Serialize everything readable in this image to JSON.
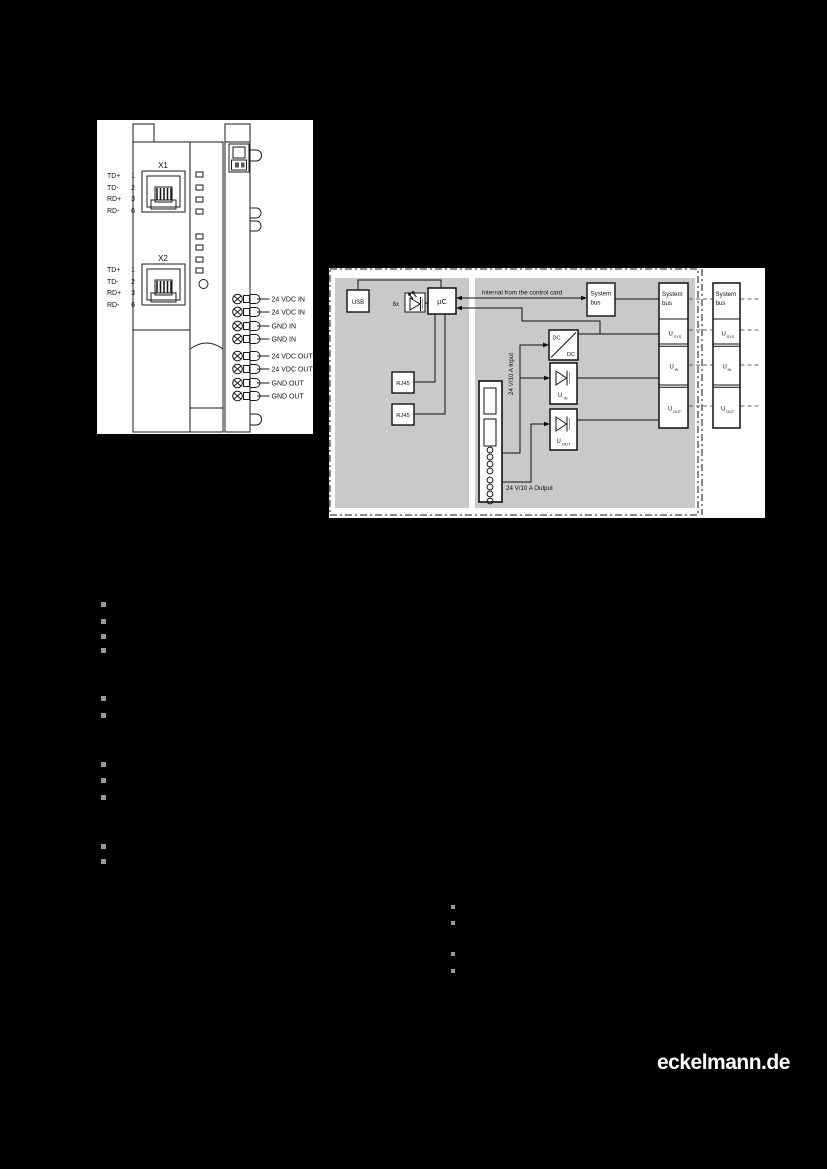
{
  "page": {
    "brand_link": "eckelmann.de"
  },
  "colors": {
    "panel_gray": "#c9c9c9",
    "diagram_bg": "#ffffff",
    "bullet_gray": "#999999"
  },
  "device_diagram": {
    "connector_x1": {
      "label": "X1",
      "pins": [
        {
          "signal": "TD+",
          "pin": "1"
        },
        {
          "signal": "TD-",
          "pin": "2"
        },
        {
          "signal": "RD+",
          "pin": "3"
        },
        {
          "signal": "RD-",
          "pin": "6"
        }
      ]
    },
    "connector_x2": {
      "label": "X2",
      "pins": [
        {
          "signal": "TD+",
          "pin": "1"
        },
        {
          "signal": "TD-",
          "pin": "2"
        },
        {
          "signal": "RD+",
          "pin": "3"
        },
        {
          "signal": "RD-",
          "pin": "6"
        }
      ]
    },
    "terminals": [
      "24 VDC IN",
      "24 VDC IN",
      "GND IN",
      "GND IN",
      "24 VDC OUT",
      "24 VDC OUT",
      "GND OUT",
      "GND OUT"
    ]
  },
  "block_diagram": {
    "usb_label": "USB",
    "led_label": "8x",
    "mcu_label": "µC",
    "rj45_top": "RJ45",
    "rj45_bottom": "RJ45",
    "internal_note": "Internal from the control card",
    "system_bus_mid": {
      "line1": "System",
      "line2": "bus"
    },
    "dc_dc": {
      "top": "DC",
      "bottom": "DC"
    },
    "input_label": "24 V/10 A Input",
    "output_label": "24 V/10 A Output",
    "sense_in": {
      "base": "U",
      "sub": "IN"
    },
    "sense_out": {
      "base": "U",
      "sub": "OUT"
    },
    "inner_stack": {
      "bus_line1": "System",
      "bus_line2": "bus",
      "u_sys": {
        "base": "U",
        "sub": "SYS"
      },
      "u_in": {
        "base": "U",
        "sub": "IN"
      },
      "u_out": {
        "base": "U",
        "sub": "OUT"
      }
    },
    "outer_stack": {
      "bus_line1": "System",
      "bus_line2": "bus",
      "u_sys": {
        "base": "U",
        "sub": "SYS"
      },
      "u_in": {
        "base": "U",
        "sub": "IN"
      },
      "u_out": {
        "base": "U",
        "sub": "OUT"
      }
    }
  }
}
